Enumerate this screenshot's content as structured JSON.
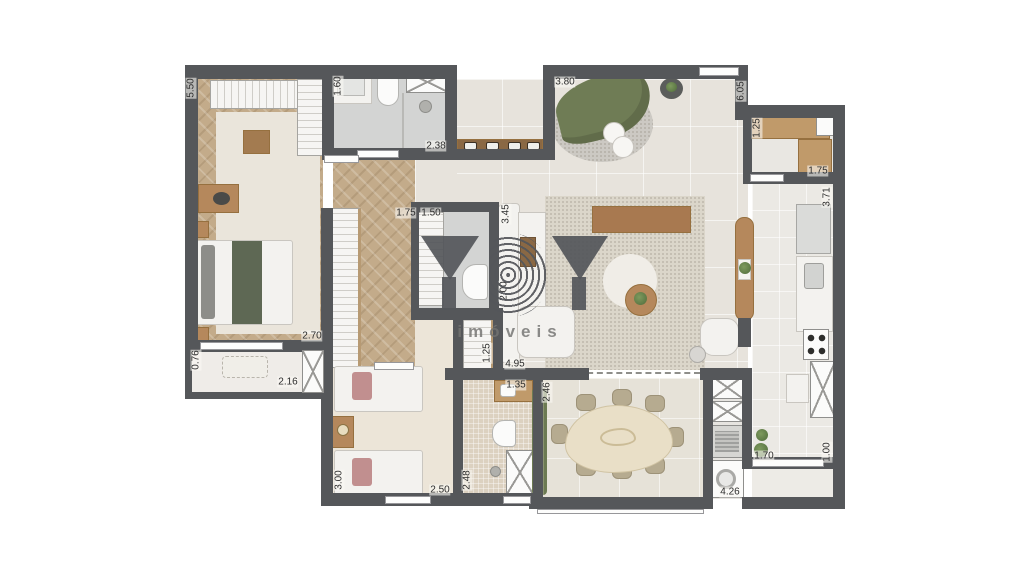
{
  "watermark": {
    "brand": "YBY",
    "subtitle": "imóveis"
  },
  "colors": {
    "wall": "#55575a",
    "wood_floor": "#c3ab8a",
    "living_floor": "#e7e3dc",
    "bath_floor": "#d3d4d3",
    "cream_floor": "#ece5d8",
    "terrace_floor": "#e6e2d8",
    "kitchen_floor": "#ebe9e4",
    "furniture_wood": "#b5885c",
    "sofa_green": "#6f7c55",
    "hedge_green": "#77815f",
    "accent_pink": "#c18f8f",
    "label_text": "#2d2d2d",
    "watermark_gray": "#54565a"
  },
  "dimension_labels": [
    {
      "text": "5.50",
      "x": 191,
      "y": 88,
      "rot": true
    },
    {
      "text": "1.60",
      "x": 338,
      "y": 86,
      "rot": true
    },
    {
      "text": "2.38",
      "x": 436,
      "y": 146,
      "rot": false
    },
    {
      "text": "3.80",
      "x": 565,
      "y": 82,
      "rot": false
    },
    {
      "text": "6.05",
      "x": 741,
      "y": 91,
      "rot": true
    },
    {
      "text": "1.25",
      "x": 757,
      "y": 128,
      "rot": true
    },
    {
      "text": "1.75",
      "x": 818,
      "y": 171,
      "rot": false
    },
    {
      "text": "3.71",
      "x": 827,
      "y": 197,
      "rot": true
    },
    {
      "text": "1.75",
      "x": 406,
      "y": 213,
      "rot": false
    },
    {
      "text": "1.50",
      "x": 431,
      "y": 213,
      "rot": false
    },
    {
      "text": "3.45",
      "x": 506,
      "y": 214,
      "rot": true
    },
    {
      "text": "2.00",
      "x": 504,
      "y": 291,
      "rot": true
    },
    {
      "text": "2.70",
      "x": 312,
      "y": 336,
      "rot": false
    },
    {
      "text": "0.76",
      "x": 196,
      "y": 360,
      "rot": true
    },
    {
      "text": "2.16",
      "x": 288,
      "y": 382,
      "rot": false
    },
    {
      "text": "1.25",
      "x": 487,
      "y": 353,
      "rot": true
    },
    {
      "text": "4.95",
      "x": 515,
      "y": 364,
      "rot": false
    },
    {
      "text": "1.35",
      "x": 516,
      "y": 385,
      "rot": false
    },
    {
      "text": "2.46",
      "x": 547,
      "y": 392,
      "rot": true
    },
    {
      "text": "3.00",
      "x": 339,
      "y": 480,
      "rot": true
    },
    {
      "text": "2.50",
      "x": 440,
      "y": 490,
      "rot": false
    },
    {
      "text": "2.48",
      "x": 467,
      "y": 480,
      "rot": true
    },
    {
      "text": "1.70",
      "x": 764,
      "y": 456,
      "rot": false
    },
    {
      "text": "1.00",
      "x": 827,
      "y": 452,
      "rot": true
    },
    {
      "text": "4.26",
      "x": 730,
      "y": 492,
      "rot": false
    }
  ]
}
